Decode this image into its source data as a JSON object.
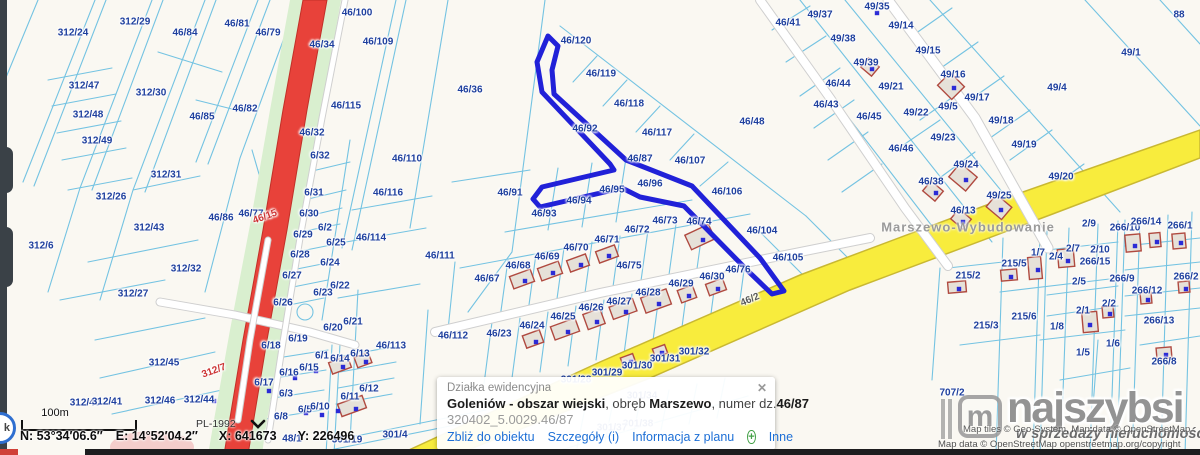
{
  "colors": {
    "selected": "#2121d8",
    "parcel_line": "#74c3e2",
    "label": "#1e3f9e",
    "road_red": "#e8423a",
    "road_yellow": "#f8ec3d",
    "green_buffer": "#d9efcf",
    "link_blue": "#1d6fd6",
    "plus_green": "#43a047"
  },
  "status_bar": {
    "scale_label": "100m",
    "crs": "PL-1992",
    "coord_n": "N: 53°34′06.6″",
    "coord_e": "E: 14°52′04.2″",
    "coord_x": "X: 641673",
    "coord_y": "Y: 226496"
  },
  "popup": {
    "title": "Działka ewidencyjna",
    "close": "✕",
    "name_bold": "Goleniów - obszar wiejski",
    "mid1": ", obręb ",
    "name_bold2": "Marszewo",
    "mid2": ", numer dz.",
    "parcel_bold": "46/87",
    "id_line": "320402_5.0029.46/87",
    "links": {
      "zoom_to": "Zbliż do obiektu",
      "details": "Szczegóły (i)",
      "plan_info": "Informacja z planu",
      "more": "Inne"
    },
    "plus": "+"
  },
  "watermark": {
    "logo_m": "m",
    "logo": "najszybsi",
    "tagline": "w sprzedaży nieruchomości",
    "attr1": "Map tiles © Geo-System, Map data © OpenStreetMap",
    "attr2": "Map data © OpenStreetMap openstreetmap.org/copyright"
  },
  "nav_glyph": "k",
  "map": {
    "place_label": {
      "t": "Marszewo-Wybudowanie",
      "x": 968,
      "y": 227
    },
    "selected_parcel": "46/87",
    "labels": [
      {
        "t": "312/24",
        "x": 73,
        "y": 33
      },
      {
        "t": "312/29",
        "x": 135,
        "y": 22
      },
      {
        "t": "46/84",
        "x": 185,
        "y": 33
      },
      {
        "t": "46/81",
        "x": 237,
        "y": 24
      },
      {
        "t": "46/79",
        "x": 268,
        "y": 33
      },
      {
        "t": "312/47",
        "x": 84,
        "y": 86
      },
      {
        "t": "312/30",
        "x": 151,
        "y": 93
      },
      {
        "t": "46/85",
        "x": 202,
        "y": 117
      },
      {
        "t": "46/82",
        "x": 245,
        "y": 109
      },
      {
        "t": "312/48",
        "x": 88,
        "y": 115
      },
      {
        "t": "312/49",
        "x": 97,
        "y": 141
      },
      {
        "t": "312/26",
        "x": 111,
        "y": 197
      },
      {
        "t": "312/31",
        "x": 166,
        "y": 175
      },
      {
        "t": "312/43",
        "x": 149,
        "y": 228
      },
      {
        "t": "312/6",
        "x": 41,
        "y": 246
      },
      {
        "t": "46/86",
        "x": 221,
        "y": 218
      },
      {
        "t": "46/77",
        "x": 251,
        "y": 214
      },
      {
        "t": "46/15",
        "x": 265,
        "y": 217,
        "c": "#c33",
        "r": -20
      },
      {
        "t": "312/32",
        "x": 186,
        "y": 269
      },
      {
        "t": "312/27",
        "x": 133,
        "y": 294
      },
      {
        "t": "312/45",
        "x": 164,
        "y": 363
      },
      {
        "t": "312/7",
        "x": 214,
        "y": 371,
        "c": "#c33",
        "r": -20
      },
      {
        "t": "312/46",
        "x": 160,
        "y": 401
      },
      {
        "t": "312/44",
        "x": 199,
        "y": 400
      },
      {
        "t": "312/40",
        "x": 85,
        "y": 403
      },
      {
        "t": "312/41",
        "x": 107,
        "y": 402
      },
      {
        "t": "46/34",
        "x": 322,
        "y": 45
      },
      {
        "t": "46/32",
        "x": 312,
        "y": 133
      },
      {
        "t": "6/32",
        "x": 320,
        "y": 156
      },
      {
        "t": "6/31",
        "x": 314,
        "y": 193
      },
      {
        "t": "6/30",
        "x": 309,
        "y": 214
      },
      {
        "t": "6/2",
        "x": 325,
        "y": 228
      },
      {
        "t": "6/29",
        "x": 303,
        "y": 235
      },
      {
        "t": "6/25",
        "x": 336,
        "y": 243
      },
      {
        "t": "6/28",
        "x": 300,
        "y": 255
      },
      {
        "t": "6/24",
        "x": 330,
        "y": 263
      },
      {
        "t": "6/27",
        "x": 292,
        "y": 276
      },
      {
        "t": "6/22",
        "x": 340,
        "y": 286
      },
      {
        "t": "6/23",
        "x": 323,
        "y": 293
      },
      {
        "t": "6/26",
        "x": 283,
        "y": 303
      },
      {
        "t": "6/21",
        "x": 353,
        "y": 322
      },
      {
        "t": "6/20",
        "x": 333,
        "y": 328
      },
      {
        "t": "6/19",
        "x": 298,
        "y": 339
      },
      {
        "t": "6/18",
        "x": 271,
        "y": 346
      },
      {
        "t": "6/1",
        "x": 322,
        "y": 356
      },
      {
        "t": "6/14",
        "x": 340,
        "y": 359
      },
      {
        "t": "6/13",
        "x": 360,
        "y": 354
      },
      {
        "t": "6/16",
        "x": 289,
        "y": 373
      },
      {
        "t": "6/15",
        "x": 309,
        "y": 368
      },
      {
        "t": "6/17",
        "x": 264,
        "y": 383
      },
      {
        "t": "6/3",
        "x": 286,
        "y": 394
      },
      {
        "t": "6/12",
        "x": 369,
        "y": 389
      },
      {
        "t": "6/11",
        "x": 350,
        "y": 397
      },
      {
        "t": "6/5",
        "x": 305,
        "y": 410
      },
      {
        "t": "6/10",
        "x": 320,
        "y": 407
      },
      {
        "t": "6/8",
        "x": 281,
        "y": 417
      },
      {
        "t": "48/1",
        "x": 292,
        "y": 439
      },
      {
        "t": "46/100",
        "x": 357,
        "y": 13
      },
      {
        "t": "46/109",
        "x": 378,
        "y": 42
      },
      {
        "t": "46/115",
        "x": 346,
        "y": 106
      },
      {
        "t": "46/110",
        "x": 407,
        "y": 159
      },
      {
        "t": "46/116",
        "x": 388,
        "y": 193
      },
      {
        "t": "46/114",
        "x": 371,
        "y": 238
      },
      {
        "t": "46/111",
        "x": 440,
        "y": 256
      },
      {
        "t": "46/113",
        "x": 391,
        "y": 346
      },
      {
        "t": "46/112",
        "x": 453,
        "y": 336
      },
      {
        "t": "46/36",
        "x": 470,
        "y": 90
      },
      {
        "t": "46/120",
        "x": 576,
        "y": 41
      },
      {
        "t": "46/119",
        "x": 601,
        "y": 74
      },
      {
        "t": "46/118",
        "x": 629,
        "y": 104
      },
      {
        "t": "46/117",
        "x": 657,
        "y": 133
      },
      {
        "t": "46/92",
        "x": 585,
        "y": 129
      },
      {
        "t": "46/87",
        "x": 640,
        "y": 159
      },
      {
        "t": "46/107",
        "x": 690,
        "y": 161
      },
      {
        "t": "46/96",
        "x": 650,
        "y": 184
      },
      {
        "t": "46/106",
        "x": 727,
        "y": 192
      },
      {
        "t": "46/91",
        "x": 510,
        "y": 193
      },
      {
        "t": "46/95",
        "x": 612,
        "y": 190
      },
      {
        "t": "46/94",
        "x": 579,
        "y": 201
      },
      {
        "t": "46/93",
        "x": 544,
        "y": 214
      },
      {
        "t": "46/48",
        "x": 752,
        "y": 122
      },
      {
        "t": "46/104",
        "x": 762,
        "y": 231
      },
      {
        "t": "46/105",
        "x": 788,
        "y": 258
      },
      {
        "t": "46/73",
        "x": 665,
        "y": 221
      },
      {
        "t": "46/74",
        "x": 699,
        "y": 222
      },
      {
        "t": "46/72",
        "x": 637,
        "y": 230
      },
      {
        "t": "46/71",
        "x": 607,
        "y": 240
      },
      {
        "t": "46/70",
        "x": 576,
        "y": 248
      },
      {
        "t": "46/69",
        "x": 547,
        "y": 257
      },
      {
        "t": "46/68",
        "x": 518,
        "y": 266
      },
      {
        "t": "46/75",
        "x": 629,
        "y": 266
      },
      {
        "t": "46/67",
        "x": 487,
        "y": 279
      },
      {
        "t": "46/76",
        "x": 738,
        "y": 270
      },
      {
        "t": "46/30",
        "x": 712,
        "y": 277
      },
      {
        "t": "46/29",
        "x": 681,
        "y": 284
      },
      {
        "t": "46/28",
        "x": 648,
        "y": 293
      },
      {
        "t": "46/27",
        "x": 619,
        "y": 302
      },
      {
        "t": "46/26",
        "x": 591,
        "y": 308
      },
      {
        "t": "46/25",
        "x": 563,
        "y": 317
      },
      {
        "t": "46/24",
        "x": 532,
        "y": 326
      },
      {
        "t": "46/23",
        "x": 499,
        "y": 334
      },
      {
        "t": "46/2",
        "x": 750,
        "y": 300,
        "c": "#595959",
        "r": -23
      },
      {
        "t": "301/32",
        "x": 694,
        "y": 352
      },
      {
        "t": "301/31",
        "x": 665,
        "y": 359
      },
      {
        "t": "301/30",
        "x": 637,
        "y": 366
      },
      {
        "t": "301/29",
        "x": 607,
        "y": 373
      },
      {
        "t": "301/28",
        "x": 576,
        "y": 380
      },
      {
        "t": "301/34",
        "x": 642,
        "y": 396
      },
      {
        "t": "301/38",
        "x": 638,
        "y": 424
      },
      {
        "t": "301/37",
        "x": 612,
        "y": 428
      },
      {
        "t": "301/19",
        "x": 347,
        "y": 440
      },
      {
        "t": "301/4",
        "x": 395,
        "y": 435
      },
      {
        "t": "49/37",
        "x": 820,
        "y": 15
      },
      {
        "t": "49/35",
        "x": 877,
        "y": 7
      },
      {
        "t": "49/14",
        "x": 901,
        "y": 26
      },
      {
        "t": "46/41",
        "x": 788,
        "y": 23
      },
      {
        "t": "49/38",
        "x": 843,
        "y": 39
      },
      {
        "t": "49/15",
        "x": 928,
        "y": 51
      },
      {
        "t": "49/39",
        "x": 866,
        "y": 63
      },
      {
        "t": "49/16",
        "x": 953,
        "y": 75
      },
      {
        "t": "46/44",
        "x": 838,
        "y": 84
      },
      {
        "t": "49/21",
        "x": 891,
        "y": 87
      },
      {
        "t": "49/17",
        "x": 977,
        "y": 98
      },
      {
        "t": "46/43",
        "x": 826,
        "y": 105
      },
      {
        "t": "49/5",
        "x": 948,
        "y": 107
      },
      {
        "t": "49/22",
        "x": 916,
        "y": 113
      },
      {
        "t": "46/45",
        "x": 869,
        "y": 117
      },
      {
        "t": "49/18",
        "x": 1001,
        "y": 121
      },
      {
        "t": "49/19",
        "x": 1024,
        "y": 145
      },
      {
        "t": "49/20",
        "x": 1061,
        "y": 177
      },
      {
        "t": "49/1",
        "x": 1131,
        "y": 53
      },
      {
        "t": "88",
        "x": 1179,
        "y": 15
      },
      {
        "t": "49/4",
        "x": 1057,
        "y": 88
      },
      {
        "t": "49/23",
        "x": 943,
        "y": 138
      },
      {
        "t": "46/46",
        "x": 901,
        "y": 149
      },
      {
        "t": "49/24",
        "x": 966,
        "y": 165
      },
      {
        "t": "46/38",
        "x": 931,
        "y": 182
      },
      {
        "t": "49/25",
        "x": 999,
        "y": 196
      },
      {
        "t": "46/13",
        "x": 963,
        "y": 211
      },
      {
        "t": "707/2",
        "x": 952,
        "y": 393
      },
      {
        "t": "2/9",
        "x": 1089,
        "y": 224
      },
      {
        "t": "266/10",
        "x": 1125,
        "y": 228
      },
      {
        "t": "266/14",
        "x": 1146,
        "y": 222
      },
      {
        "t": "266/1",
        "x": 1180,
        "y": 226
      },
      {
        "t": "2/7",
        "x": 1073,
        "y": 249
      },
      {
        "t": "2/10",
        "x": 1100,
        "y": 250
      },
      {
        "t": "1/7",
        "x": 1038,
        "y": 253
      },
      {
        "t": "2/4",
        "x": 1056,
        "y": 257
      },
      {
        "t": "215/5",
        "x": 1014,
        "y": 264
      },
      {
        "t": "266/15",
        "x": 1095,
        "y": 262
      },
      {
        "t": "215/2",
        "x": 968,
        "y": 276
      },
      {
        "t": "266/9",
        "x": 1122,
        "y": 279
      },
      {
        "t": "266/2",
        "x": 1186,
        "y": 277
      },
      {
        "t": "2/5",
        "x": 1079,
        "y": 282
      },
      {
        "t": "266/12",
        "x": 1147,
        "y": 291
      },
      {
        "t": "2/2",
        "x": 1109,
        "y": 304
      },
      {
        "t": "2/1",
        "x": 1083,
        "y": 311
      },
      {
        "t": "215/6",
        "x": 1024,
        "y": 317
      },
      {
        "t": "215/3",
        "x": 986,
        "y": 326
      },
      {
        "t": "266/13",
        "x": 1159,
        "y": 321
      },
      {
        "t": "1/8",
        "x": 1057,
        "y": 327
      },
      {
        "t": "266/8",
        "x": 1164,
        "y": 362
      },
      {
        "t": "1/6",
        "x": 1113,
        "y": 344
      },
      {
        "t": "1/5",
        "x": 1083,
        "y": 353
      }
    ],
    "buildings": [
      [
        522,
        279,
        22,
        13,
        -20
      ],
      [
        550,
        271,
        22,
        13,
        -20
      ],
      [
        578,
        263,
        20,
        12,
        -20
      ],
      [
        607,
        254,
        20,
        12,
        -20
      ],
      [
        700,
        237,
        26,
        16,
        -25
      ],
      [
        533,
        339,
        18,
        13,
        -20
      ],
      [
        565,
        329,
        26,
        14,
        -20
      ],
      [
        594,
        319,
        18,
        16,
        -20
      ],
      [
        623,
        309,
        25,
        13,
        -20
      ],
      [
        656,
        301,
        27,
        16,
        -20
      ],
      [
        687,
        294,
        16,
        13,
        -20
      ],
      [
        716,
        287,
        18,
        12,
        -20
      ],
      [
        340,
        365,
        20,
        12,
        -20
      ],
      [
        363,
        360,
        15,
        11,
        -20
      ],
      [
        352,
        406,
        26,
        13,
        -20
      ],
      [
        870,
        67,
        14,
        12,
        40
      ],
      [
        951,
        86,
        20,
        18,
        45
      ],
      [
        963,
        177,
        22,
        18,
        40
      ],
      [
        933,
        191,
        16,
        13,
        40
      ],
      [
        999,
        207,
        20,
        16,
        40
      ],
      [
        961,
        219,
        16,
        13,
        40
      ],
      [
        957,
        287,
        18,
        11,
        -5
      ],
      [
        1009,
        275,
        16,
        11,
        -5
      ],
      [
        1035,
        268,
        13,
        22,
        -5
      ],
      [
        1066,
        258,
        16,
        18,
        -5
      ],
      [
        1090,
        322,
        15,
        20,
        -5
      ],
      [
        1108,
        312,
        11,
        11,
        -5
      ],
      [
        1133,
        243,
        15,
        17,
        -5
      ],
      [
        1155,
        240,
        11,
        14,
        -5
      ],
      [
        1179,
        241,
        13,
        15,
        -5
      ],
      [
        1146,
        298,
        11,
        11,
        -5
      ],
      [
        1184,
        287,
        11,
        11,
        -5
      ],
      [
        1164,
        353,
        15,
        11,
        -5
      ],
      [
        628,
        360,
        13,
        9,
        -20
      ],
      [
        660,
        351,
        13,
        9,
        -20
      ]
    ],
    "dots": [
      [
        877,
        13
      ],
      [
        295,
        378
      ],
      [
        316,
        371
      ],
      [
        269,
        391
      ],
      [
        306,
        413
      ],
      [
        322,
        415
      ],
      [
        338,
        411
      ],
      [
        172,
        400
      ],
      [
        214,
        401
      ],
      [
        525,
        281
      ],
      [
        553,
        273
      ],
      [
        581,
        265
      ],
      [
        609,
        256
      ],
      [
        703,
        240
      ],
      [
        536,
        342
      ],
      [
        568,
        332
      ],
      [
        597,
        322
      ],
      [
        626,
        312
      ],
      [
        659,
        304
      ],
      [
        689,
        296
      ],
      [
        718,
        289
      ],
      [
        343,
        367
      ],
      [
        366,
        362
      ],
      [
        356,
        409
      ],
      [
        1090,
        325
      ],
      [
        1110,
        314
      ],
      [
        1135,
        246
      ],
      [
        1157,
        242
      ],
      [
        1181,
        243
      ],
      [
        1148,
        300
      ],
      [
        1186,
        289
      ],
      [
        1166,
        355
      ],
      [
        959,
        289
      ],
      [
        1011,
        277
      ],
      [
        1038,
        270
      ],
      [
        1068,
        261
      ],
      [
        631,
        362
      ],
      [
        662,
        353
      ],
      [
        966,
        180
      ],
      [
        1001,
        210
      ],
      [
        963,
        222
      ],
      [
        936,
        193
      ],
      [
        872,
        69
      ],
      [
        954,
        88
      ]
    ]
  }
}
